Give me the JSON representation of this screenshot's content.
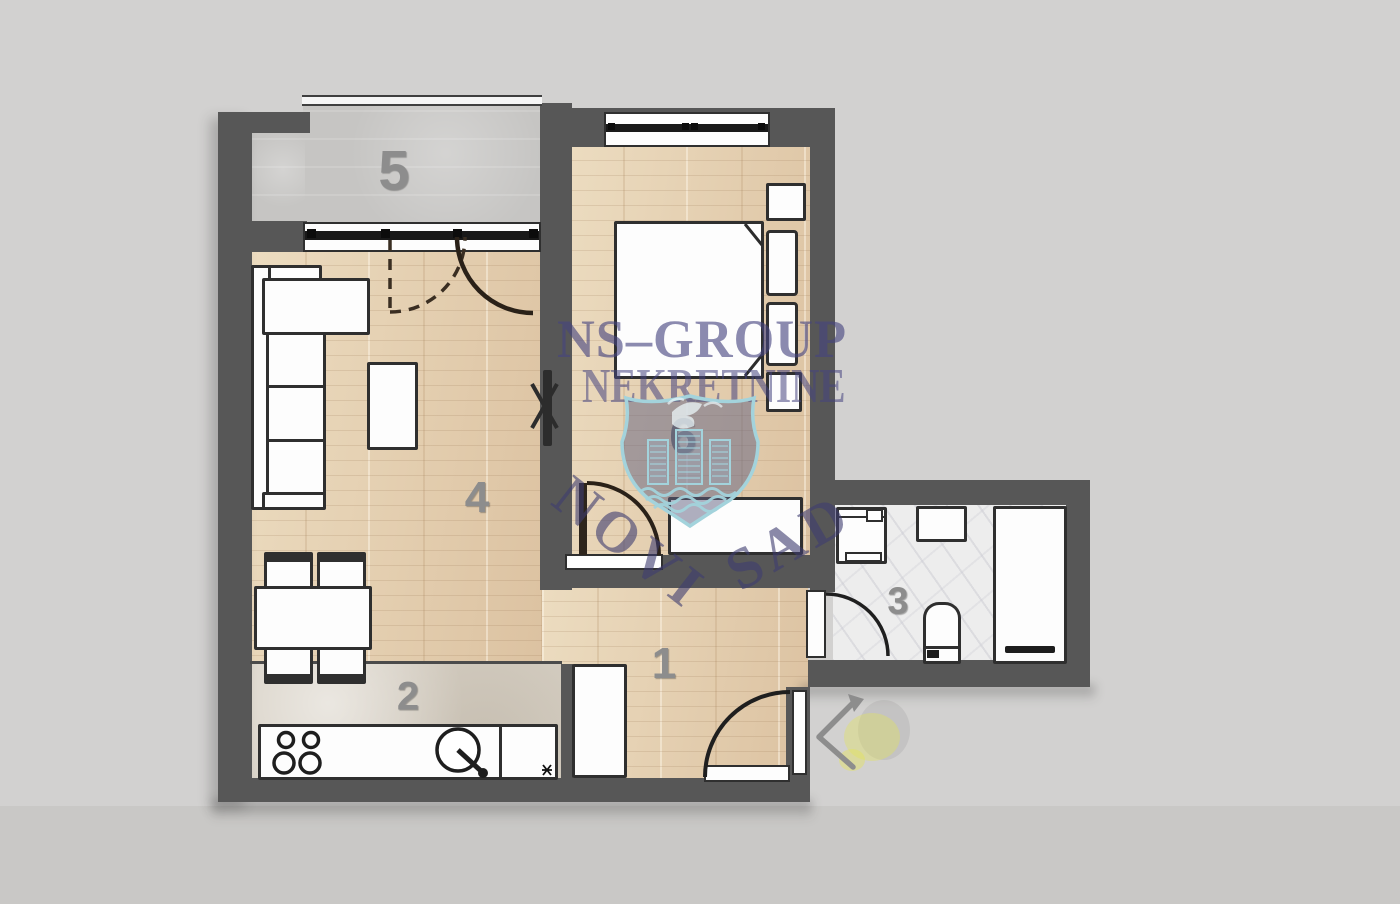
{
  "watermark": {
    "brand": "NS–GROUP",
    "subtitle": "NEKRETNINE",
    "city_word1": "NOVI",
    "city_word2": "SAD",
    "logo": "novi-sad-shield-with-towers-dove-and-waves"
  },
  "rooms": {
    "hall": "1",
    "kitchen": "2",
    "bathroom": "3",
    "living_room": "4",
    "terrace": "5",
    "bedroom": "6"
  },
  "colors": {
    "background": "#d2d1d0",
    "wall": "#575757",
    "wood_floor": "#e4cfb0",
    "terrace_floor": "#c6c5c3",
    "kitchen_floor": "#d6cfc3",
    "bathroom_floor": "#ededed",
    "furniture_outline": "#2f2f2f",
    "furniture_fill": "#fdfdfd",
    "room_label": "#8d8d8d",
    "watermark_text": "#46447f",
    "shield_outline": "#a3d3dc",
    "entrance_arrow": "#8d8d8d",
    "entrance_highlight": "#e6e650"
  },
  "icons": {
    "entrance_arrow": "chevron-left-icon"
  }
}
